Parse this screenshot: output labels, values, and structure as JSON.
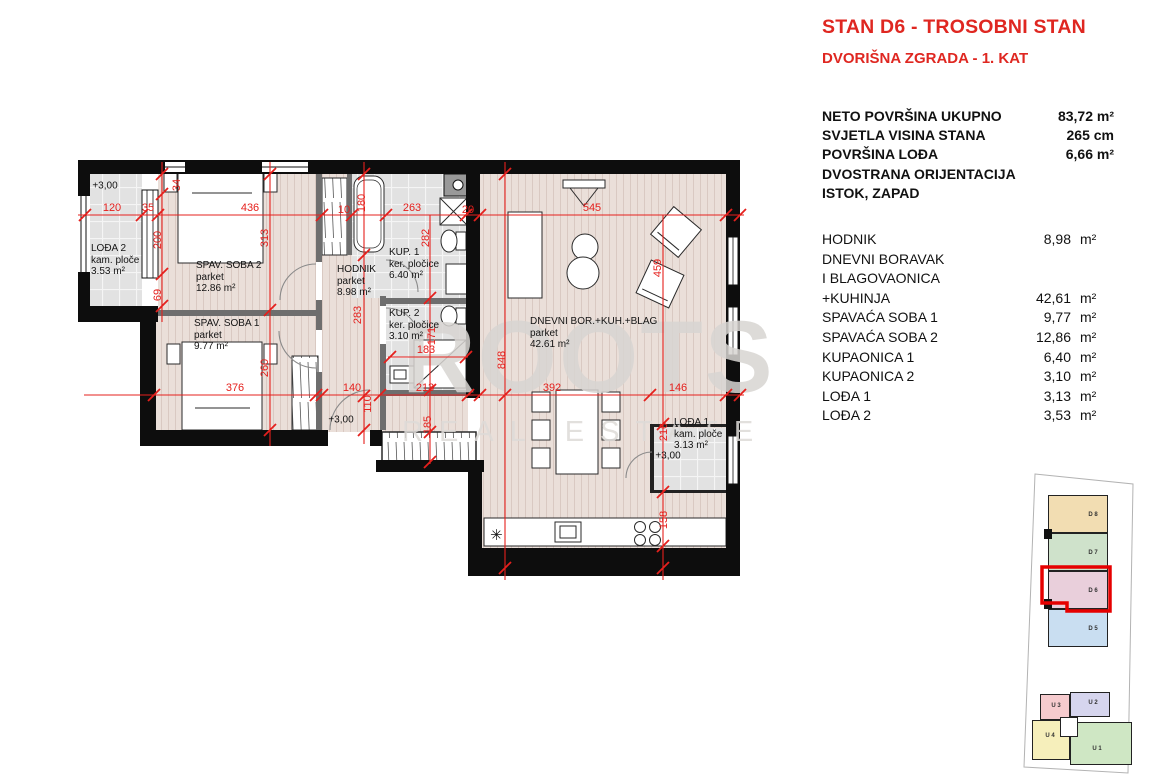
{
  "header": {
    "title": "STAN D6 - TROSOBNI STAN",
    "subtitle": "DVORIŠNA ZGRADA - 1. KAT"
  },
  "summary": [
    {
      "label": "NETO POVRŠINA UKUPNO",
      "value": "83,72 m²"
    },
    {
      "label": "SVJETLA VISINA STANA",
      "value": "265 cm"
    },
    {
      "label": "POVRŠINA LOĐA",
      "value": "6,66 m²"
    },
    {
      "label": "DVOSTRANA ORIJENTACIJA",
      "value": ""
    },
    {
      "label": "ISTOK, ZAPAD",
      "value": ""
    }
  ],
  "rooms": [
    {
      "label": "HODNIK",
      "value": "8,98",
      "unit": "m²"
    },
    {
      "label": "DNEVNI BORAVAK",
      "value": "",
      "unit": ""
    },
    {
      "label": "I BLAGOVAONICA",
      "value": "",
      "unit": ""
    },
    {
      "label": "+KUHINJA",
      "value": "42,61",
      "unit": "m²"
    },
    {
      "label": "SPAVAĆA SOBA 1",
      "value": "9,77",
      "unit": "m²"
    },
    {
      "label": "SPAVAĆA SOBA 2",
      "value": "12,86",
      "unit": "m²"
    },
    {
      "label": "KUPAONICA 1",
      "value": "6,40",
      "unit": "m²"
    },
    {
      "label": "KUPAONICA 2",
      "value": "3,10",
      "unit": "m²"
    },
    {
      "label": "LOĐA 1",
      "value": "3,13",
      "unit": "m²"
    },
    {
      "label": "LOĐA 2",
      "value": "3,53",
      "unit": "m²"
    }
  ],
  "watermark": {
    "line1": "ROOTS",
    "line2": "REAL ESTATE"
  },
  "plan": {
    "room_labels": [
      {
        "name": "LOĐA 2",
        "sub": "kam. ploče",
        "area": "3.53 m²",
        "x": 91,
        "y": 243
      },
      {
        "name": "SPAV. SOBA 2",
        "sub": "parket",
        "area": "12.86 m²",
        "x": 196,
        "y": 260
      },
      {
        "name": "SPAV. SOBA 1",
        "sub": "parket",
        "area": "9.77 m²",
        "x": 194,
        "y": 318
      },
      {
        "name": "HODNIK",
        "sub": "parket",
        "area": "8.98 m²",
        "x": 337,
        "y": 264
      },
      {
        "name": "KUP. 1",
        "sub": "ker. pločice",
        "area": "6.40 m²",
        "x": 389,
        "y": 247
      },
      {
        "name": "KUP. 2",
        "sub": "ker. pločice",
        "area": "3.10 m²",
        "x": 389,
        "y": 308
      },
      {
        "name": "DNEVNI BOR.+KUH.+BLAG",
        "sub": "parket",
        "area": "42.61 m²",
        "x": 530,
        "y": 316
      },
      {
        "name": "LOĐA 1",
        "sub": "kam. ploče",
        "area": "3.13 m²",
        "x": 674,
        "y": 417
      }
    ],
    "levels": [
      {
        "text": "+3,00",
        "x": 105,
        "y": 186
      },
      {
        "text": "+3,00",
        "x": 341,
        "y": 420
      },
      {
        "text": "+3,00",
        "x": 668,
        "y": 456
      }
    ],
    "dims": [
      {
        "t": "120",
        "x": 112,
        "y": 208
      },
      {
        "t": "35",
        "x": 148,
        "y": 208
      },
      {
        "t": "436",
        "x": 250,
        "y": 208
      },
      {
        "t": "10",
        "x": 344,
        "y": 210
      },
      {
        "t": "263",
        "x": 412,
        "y": 208
      },
      {
        "t": "20",
        "x": 468,
        "y": 210
      },
      {
        "t": "545",
        "x": 592,
        "y": 208
      },
      {
        "t": "376",
        "x": 235,
        "y": 388
      },
      {
        "t": "140",
        "x": 352,
        "y": 388
      },
      {
        "t": "213",
        "x": 425,
        "y": 388
      },
      {
        "t": "392",
        "x": 552,
        "y": 388
      },
      {
        "t": "146",
        "x": 678,
        "y": 388
      },
      {
        "t": "183",
        "x": 426,
        "y": 350
      },
      {
        "t": "34",
        "x": 177,
        "y": 185,
        "rot": true
      },
      {
        "t": "200",
        "x": 158,
        "y": 240,
        "rot": true
      },
      {
        "t": "69",
        "x": 158,
        "y": 295,
        "rot": true
      },
      {
        "t": "313",
        "x": 265,
        "y": 238,
        "rot": true
      },
      {
        "t": "260",
        "x": 265,
        "y": 368,
        "rot": true
      },
      {
        "t": "180",
        "x": 362,
        "y": 203,
        "rot": true
      },
      {
        "t": "283",
        "x": 358,
        "y": 315,
        "rot": true
      },
      {
        "t": "110",
        "x": 368,
        "y": 404,
        "rot": true
      },
      {
        "t": "282",
        "x": 426,
        "y": 238,
        "rot": true
      },
      {
        "t": "171",
        "x": 432,
        "y": 336,
        "rot": true
      },
      {
        "t": "185",
        "x": 428,
        "y": 425,
        "rot": true
      },
      {
        "t": "848",
        "x": 502,
        "y": 360,
        "rot": true
      },
      {
        "t": "459",
        "x": 658,
        "y": 268,
        "rot": true
      },
      {
        "t": "216",
        "x": 664,
        "y": 432,
        "rot": true
      },
      {
        "t": "158",
        "x": 664,
        "y": 520,
        "rot": true
      }
    ]
  },
  "sitemap": {
    "highlight_color": "#e60000",
    "units": [
      {
        "label": "D 8",
        "color": "#f2ddb2",
        "highlight": false
      },
      {
        "label": "D 7",
        "color": "#cfe2cb",
        "highlight": false
      },
      {
        "label": "D 6",
        "color": "#e9cfdb",
        "highlight": true
      },
      {
        "label": "D 5",
        "color": "#c9def1",
        "highlight": false
      },
      {
        "label": "U 3",
        "color": "#f6cbce",
        "highlight": false
      },
      {
        "label": "U 2",
        "color": "#d6d5ee",
        "highlight": false
      },
      {
        "label": "U 4",
        "color": "#f6efbb",
        "highlight": false
      },
      {
        "label": "U 1",
        "color": "#cfe7c4",
        "highlight": false
      }
    ]
  }
}
